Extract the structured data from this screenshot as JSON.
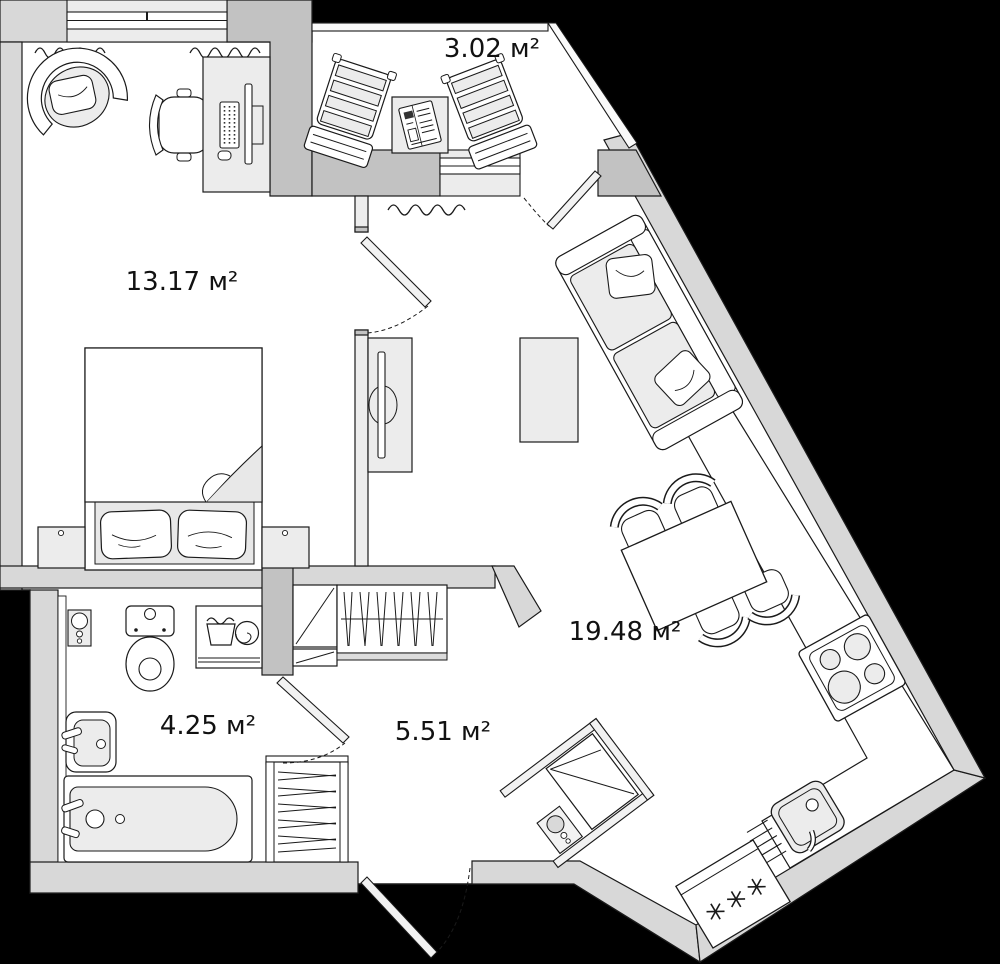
{
  "plan": {
    "type": "apartment-floor-plan",
    "colors": {
      "background": "#000000",
      "exterior_wall": "#d8d8d8",
      "bearing_pier": "#c2c2c2",
      "partition_wall": "#ededed",
      "floor": "#ffffff",
      "furniture_fill": "#ececec",
      "outline": "#1a1a1a"
    },
    "rooms": [
      {
        "id": "bedroom",
        "area_label": "13.17 м²"
      },
      {
        "id": "balcony",
        "area_label": "3.02 м²"
      },
      {
        "id": "living-room",
        "area_label": "19.48 м²"
      },
      {
        "id": "bathroom",
        "area_label": "4.25 м²"
      },
      {
        "id": "hallway",
        "area_label": "5.51 м²"
      }
    ],
    "furniture": {
      "bedroom": [
        "armchair",
        "desk",
        "desk-chair",
        "monitor",
        "keyboard",
        "mouse",
        "double-bed",
        "pillows",
        "nightstand-left",
        "nightstand-right"
      ],
      "balcony": [
        "deck-chair-left",
        "deck-chair-right",
        "side-table",
        "newspaper"
      ],
      "living-room": [
        "sofa",
        "sofa-pillows",
        "coffee-table",
        "tv-stand",
        "tv",
        "dining-table",
        "dining-chairs-x4"
      ],
      "kitchen-zone": [
        "counter",
        "stove-4-burners",
        "kitchen-sink",
        "fridge"
      ],
      "hallway": [
        "shoe-cabinet",
        "coat-wardrobe",
        "hallway-wardrobe",
        "entry-closet",
        "water-heater-panel",
        "shoe-rack"
      ],
      "bathroom": [
        "water-heater-panel",
        "toilet",
        "washing-machine",
        "wash-sink",
        "bathtub"
      ]
    },
    "doors": [
      "bedroom-door",
      "balcony-door",
      "bathroom-door",
      "entrance-door"
    ],
    "windows": [
      "bedroom-window",
      "balcony-glazing",
      "living-balcony-window"
    ],
    "icons": {
      "fridge_symbol": "three-snowflakes",
      "washing_machine_symbols": "laundry-tub-and-drum-spiral",
      "radiator_symbol": "wavy-line"
    }
  }
}
